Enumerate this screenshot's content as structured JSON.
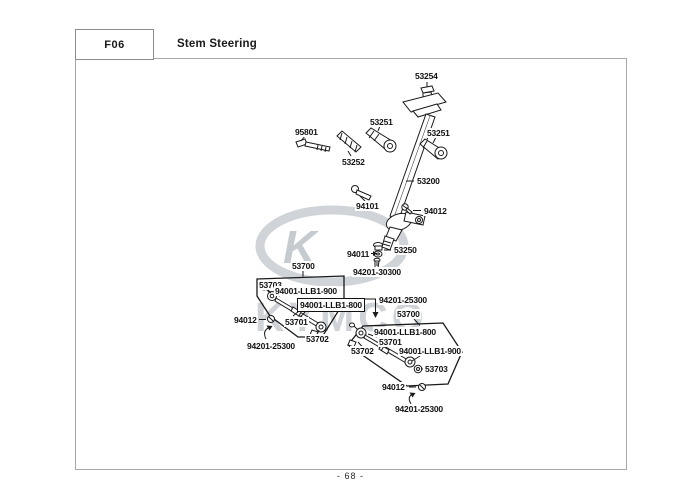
{
  "page": {
    "code": "F06",
    "title": "Stem Steering",
    "page_number": "- 68 -",
    "watermark": {
      "letter": "K",
      "brand": "KYMCO",
      "color": "#cdd2d6"
    }
  },
  "colors": {
    "diagram_line": "#1a1a1a",
    "frame_border": "#a8a8a8",
    "label_text": "#111111",
    "watermark_gray": "#cdd2d6"
  },
  "diagram": {
    "labels": [
      {
        "id": "l-53254",
        "text": "53254",
        "x": 414,
        "y": 71
      },
      {
        "id": "l-95801",
        "text": "95801",
        "x": 294,
        "y": 127
      },
      {
        "id": "l-53251-left",
        "text": "53251",
        "x": 369,
        "y": 117
      },
      {
        "id": "l-53252",
        "text": "53252",
        "x": 341,
        "y": 157
      },
      {
        "id": "l-53251-right",
        "text": "53251",
        "x": 426,
        "y": 128
      },
      {
        "id": "l-53200",
        "text": "53200",
        "x": 416,
        "y": 176
      },
      {
        "id": "l-94101",
        "text": "94101",
        "x": 355,
        "y": 201
      },
      {
        "id": "l-94012-upper",
        "text": "94012",
        "x": 423,
        "y": 206
      },
      {
        "id": "l-94011",
        "text": "94011",
        "x": 346,
        "y": 249
      },
      {
        "id": "l-53250",
        "text": "53250",
        "x": 393,
        "y": 245
      },
      {
        "id": "l-94201-30300",
        "text": "94201-30300",
        "x": 352,
        "y": 267
      },
      {
        "id": "l-53700-left",
        "text": "53700",
        "x": 291,
        "y": 261
      },
      {
        "id": "l-53703-left",
        "text": "53703",
        "x": 258,
        "y": 280
      },
      {
        "id": "l-llb900-left",
        "text": "94001-LLB1-900",
        "x": 274,
        "y": 286
      },
      {
        "id": "l-llb800-left",
        "text": "94001-LLB1-800",
        "x": 297,
        "y": 298,
        "boxed": true
      },
      {
        "id": "l-53701-left",
        "text": "53701",
        "x": 284,
        "y": 317
      },
      {
        "id": "l-53702-left",
        "text": "53702",
        "x": 305,
        "y": 334
      },
      {
        "id": "l-94012-left",
        "text": "94012",
        "x": 233,
        "y": 315
      },
      {
        "id": "l-25300-left",
        "text": "94201-25300",
        "x": 246,
        "y": 341
      },
      {
        "id": "l-25300-mid",
        "text": "94201-25300",
        "x": 378,
        "y": 295
      },
      {
        "id": "l-53700-right",
        "text": "53700",
        "x": 396,
        "y": 309
      },
      {
        "id": "l-llb800-right",
        "text": "94001-LLB1-800",
        "x": 373,
        "y": 327
      },
      {
        "id": "l-53701-right",
        "text": "53701",
        "x": 378,
        "y": 337
      },
      {
        "id": "l-53702-right",
        "text": "53702",
        "x": 350,
        "y": 346
      },
      {
        "id": "l-llb900-right",
        "text": "94001-LLB1-900",
        "x": 398,
        "y": 346
      },
      {
        "id": "l-53703-right",
        "text": "53703",
        "x": 424,
        "y": 364
      },
      {
        "id": "l-94012-bottom",
        "text": "94012",
        "x": 381,
        "y": 382
      },
      {
        "id": "l-25300-bottom",
        "text": "94201-25300",
        "x": 394,
        "y": 404
      }
    ]
  }
}
